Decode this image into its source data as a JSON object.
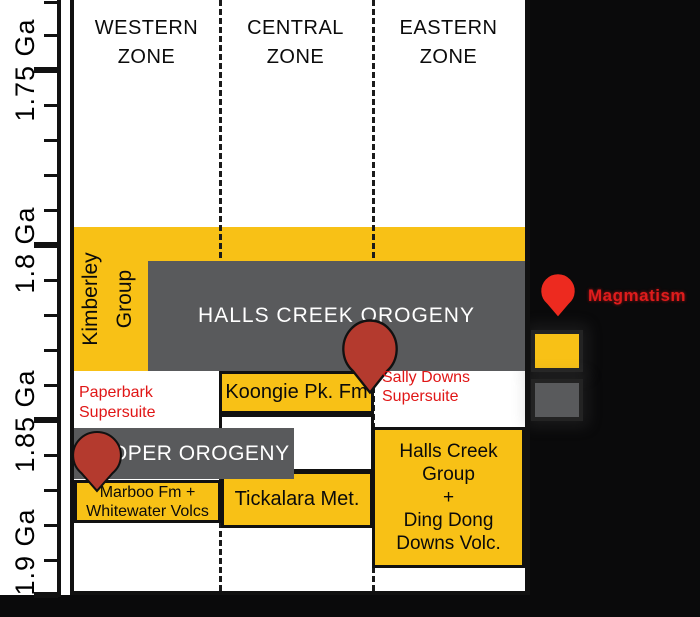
{
  "axis": {
    "unit": "Ga",
    "labels": [
      {
        "text": "1.75 Ga",
        "y": 70
      },
      {
        "text": "1.8 Ga",
        "y": 247
      },
      {
        "text": "1.85 Ga",
        "y": 421
      },
      {
        "text": "1.9 Ga",
        "y": 552
      }
    ],
    "ticks": {
      "major_y": [
        70,
        245,
        420,
        595
      ],
      "minor_y": [
        2,
        35,
        105,
        140,
        175,
        210,
        280,
        315,
        350,
        385,
        455,
        490,
        525,
        560
      ]
    }
  },
  "zones": [
    {
      "id": "western",
      "lines": [
        "WESTERN",
        "ZONE"
      ]
    },
    {
      "id": "central",
      "lines": [
        "CENTRAL",
        "ZONE"
      ]
    },
    {
      "id": "eastern",
      "lines": [
        "EASTERN",
        "ZONE"
      ]
    }
  ],
  "units": {
    "kimberley_group": {
      "lines": [
        "Kimberley",
        "Group"
      ]
    },
    "halls_creek_orogeny": "HALLS CREEK OROGENY",
    "koongie": "Koongie Pk. Fm",
    "paperbark": {
      "lines": [
        "Paperbark",
        "Supersuite"
      ]
    },
    "sally_downs": {
      "lines": [
        "Sally Downs",
        "Supersuite"
      ]
    },
    "hooper": "HOOPER OROGENY",
    "marboo": {
      "lines": [
        "Marboo Fm +",
        "Whitewater Volcs"
      ]
    },
    "tickalara": "Tickalara Met.",
    "halls_creek_group": {
      "lines": [
        "Halls Creek",
        "Group",
        "+",
        "Ding Dong",
        "Downs Volc."
      ]
    }
  },
  "legend": {
    "pin_label": "Magmatism"
  },
  "colors": {
    "unit_yellow": "#F8C116",
    "orogeny_gray": "#595A5C",
    "annotation_red": "#E01616",
    "chart_pin_red": "#B43A2E",
    "legend_pin_red": "#ED2A1F",
    "line_black": "#111111",
    "background_black": "#0A0A0B"
  },
  "chart_data": {
    "type": "table",
    "title": "Time-space correlation chart, Western / Central / Eastern zones",
    "ylabel": "Age (Ga)",
    "y_axis_ticks": [
      "1.75",
      "1.8",
      "1.85",
      "1.9"
    ],
    "ylim": [
      1.73,
      1.9
    ],
    "categories": [
      "WESTERN ZONE",
      "CENTRAL ZONE",
      "EASTERN ZONE"
    ],
    "units": [
      {
        "name": "Kimberley Group",
        "zone": "Western (band spans all zones)",
        "style": "yellow",
        "age_ga": [
          1.795,
          1.836
        ]
      },
      {
        "name": "Halls Creek Orogeny",
        "zone": "Western-Central-Eastern",
        "style": "gray orogeny",
        "age_ga": [
          1.805,
          1.836
        ]
      },
      {
        "name": "Paperbark Supersuite",
        "zone": "Western",
        "style": "red annotation",
        "age_ga": [
          1.836,
          1.852
        ]
      },
      {
        "name": "Koongie Pk. Fm",
        "zone": "Central",
        "style": "yellow",
        "age_ga": [
          1.836,
          1.848
        ]
      },
      {
        "name": "Sally Downs Supersuite",
        "zone": "Eastern",
        "style": "red annotation + magmatism pin",
        "age_ga": [
          1.836,
          1.85
        ]
      },
      {
        "name": "Hooper Orogeny",
        "zone": "Western-Central",
        "style": "gray orogeny + magmatism pin",
        "age_ga": [
          1.852,
          1.867
        ]
      },
      {
        "name": "Marboo Fm + Whitewater Volcs",
        "zone": "Western",
        "style": "yellow",
        "age_ga": [
          1.867,
          1.879
        ]
      },
      {
        "name": "Tickalara Met.",
        "zone": "Central",
        "style": "yellow",
        "age_ga": [
          1.865,
          1.881
        ]
      },
      {
        "name": "Halls Creek Group + Ding Dong Downs Volc.",
        "zone": "Eastern",
        "style": "yellow",
        "age_ga": [
          1.852,
          1.892
        ]
      }
    ],
    "legend": [
      {
        "symbol": "red map pin",
        "label": "Magmatism"
      },
      {
        "symbol": "yellow square",
        "label": ""
      },
      {
        "symbol": "gray square",
        "label": ""
      }
    ]
  }
}
